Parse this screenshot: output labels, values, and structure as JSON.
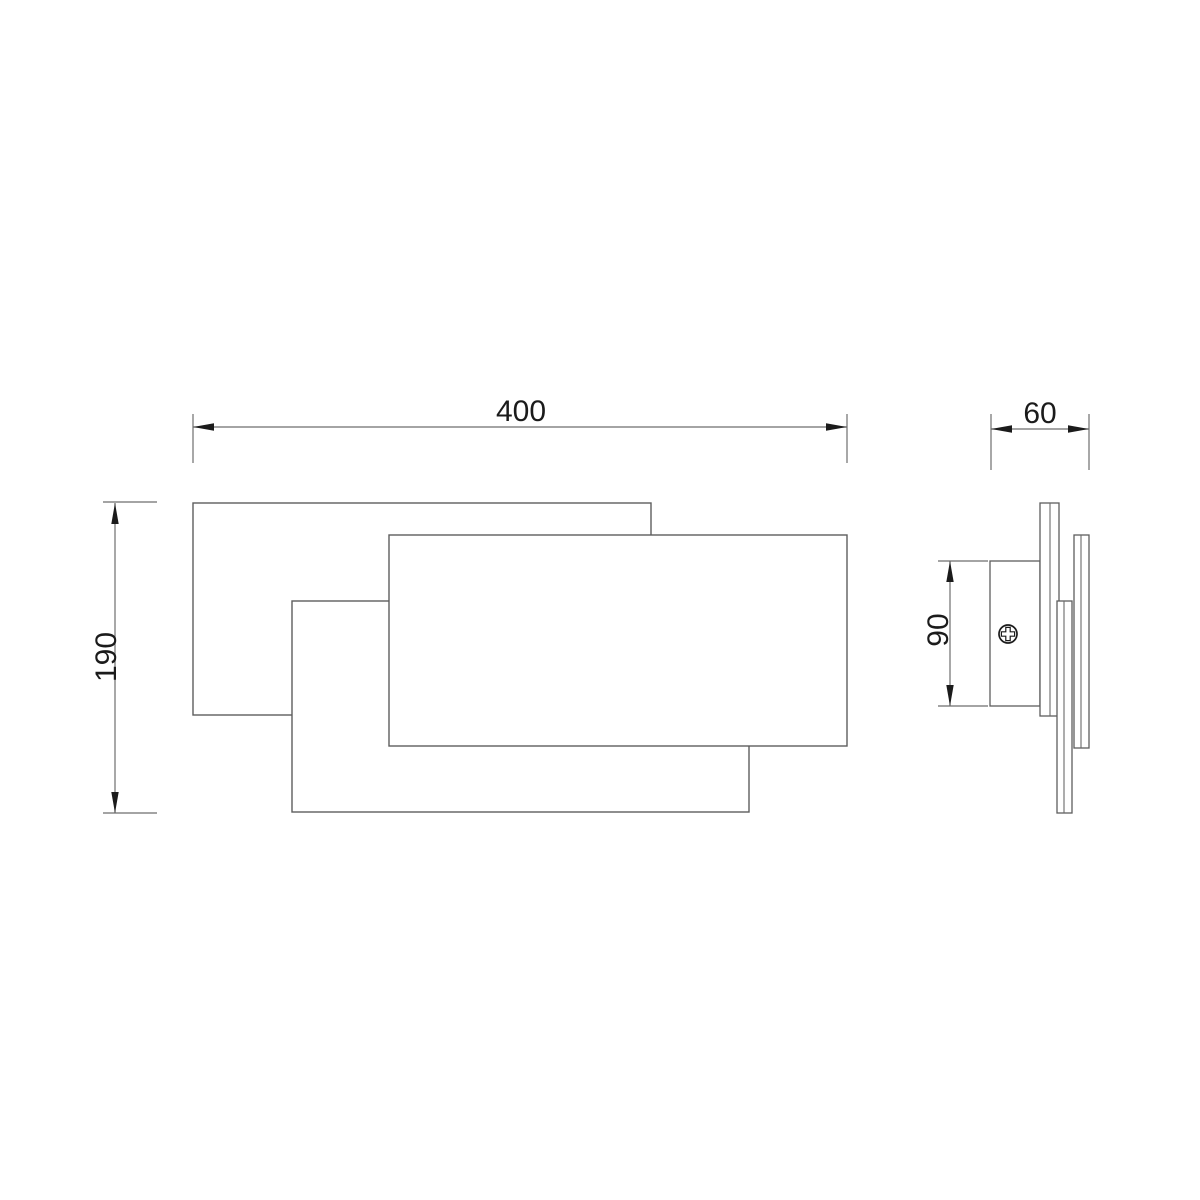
{
  "drawing": {
    "type": "technical-dimension-drawing",
    "background": "#ffffff",
    "colors": {
      "outline": "#5d5d5d",
      "dimension_lines": "#6e6e6e",
      "ink": "#1b1b1b",
      "fill": "#ffffff"
    },
    "dimensions": {
      "width": "400",
      "height": "190",
      "depth": "60",
      "bracket_height": "90"
    },
    "icons": [
      {
        "name": "phillips-screw-icon"
      }
    ]
  }
}
